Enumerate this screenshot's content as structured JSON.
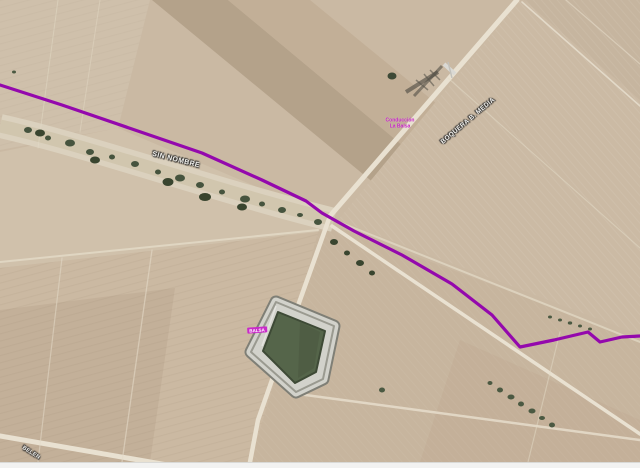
{
  "map": {
    "labels": {
      "road_sin_nombre": "SIN NOMBRE",
      "road_boquera": "BOQUERA B. MEDIA",
      "pipeline_label_line1": "Conducción",
      "pipeline_label_line2": "La Balsa",
      "pond_label": "BALSA",
      "road_belen": "BELEN"
    },
    "colors": {
      "route_line": "#9408ad",
      "pipeline_label_text": "#c41fc4",
      "pond_water": "#55654a",
      "terrain_base": "#cab9a3",
      "road_light": "#e9e1d1",
      "road_label_text": "#f4f3ef",
      "pond_label_bg": "#c92bc9"
    }
  }
}
